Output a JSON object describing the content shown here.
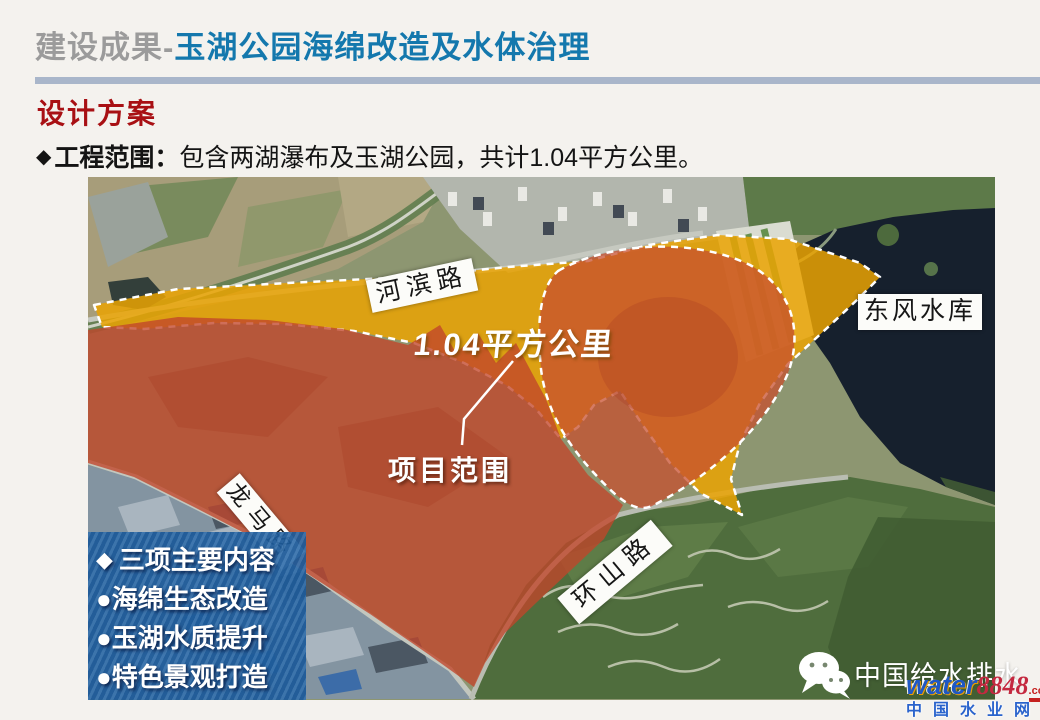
{
  "slide": {
    "title_prefix": "建设成果",
    "title_separator": "-",
    "title_main": "玉湖公园海绵改造及水体治理",
    "section_heading": "设计方案",
    "bullet_marker": "◆",
    "scope_label": "工程范围：",
    "scope_text": "包含两湖瀑布及玉湖公园，共计1.04平方公里。"
  },
  "map": {
    "road_labels": [
      {
        "text": "河滨路"
      },
      {
        "text": "龙马路"
      },
      {
        "text": "环山路"
      }
    ],
    "reservoir_label": "东风水库",
    "area_annotation": "1.04平方公里",
    "scope_annotation": "项目范围",
    "legend": {
      "title_marker": "◆",
      "title": "三项主要内容",
      "items": [
        "●海绵生态改造",
        "●玉湖水质提升",
        "●特色景观打造"
      ]
    }
  },
  "watermark": {
    "wechat_account": "中国给水排水",
    "brand_en": "water",
    "brand_num": "8848",
    "brand_tld": ".com",
    "brand_cn": "中国水业网"
  },
  "colors": {
    "title_accent": "#1478ad",
    "title_gray": "#9b9b9b",
    "section_heading": "#a81014",
    "divider": "#a9b6ca",
    "buffer_overlay_orange": "#eaa302",
    "project_overlay_red": "#c1452a",
    "legend_panel_blue": "#2263a4",
    "reservoir_water": "#16202d"
  }
}
